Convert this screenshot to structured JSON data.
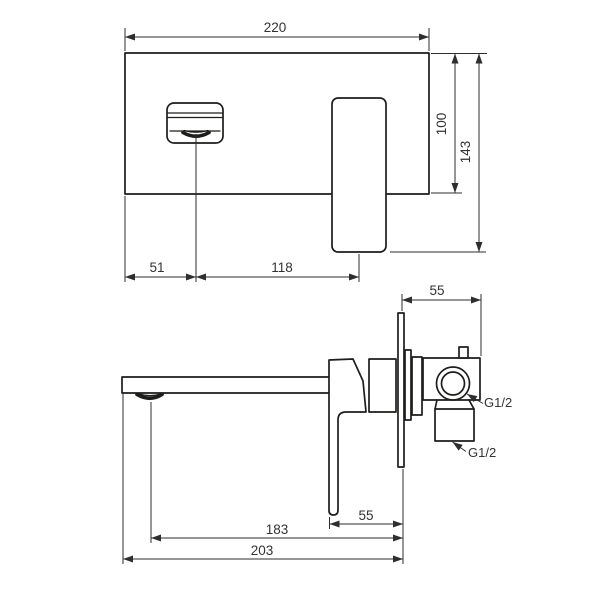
{
  "drawing": {
    "kind": "technical-dimension-drawing",
    "subject": "wall-mounted-basin-mixer-tap"
  },
  "colors": {
    "background": "#ffffff",
    "object_line": "#1d1d1b",
    "dimension_line": "#2e2e2e",
    "text": "#333333"
  },
  "front_view": {
    "width": "220",
    "plate_height": "100",
    "total_height": "143",
    "spout_offset": "51",
    "spout_to_handle": "118"
  },
  "side_view": {
    "valve_depth": "55",
    "lever_to_wall": "55",
    "spout_reach": "183",
    "total_reach": "203",
    "thread_top": "G1/2",
    "thread_bottom": "G1/2"
  }
}
